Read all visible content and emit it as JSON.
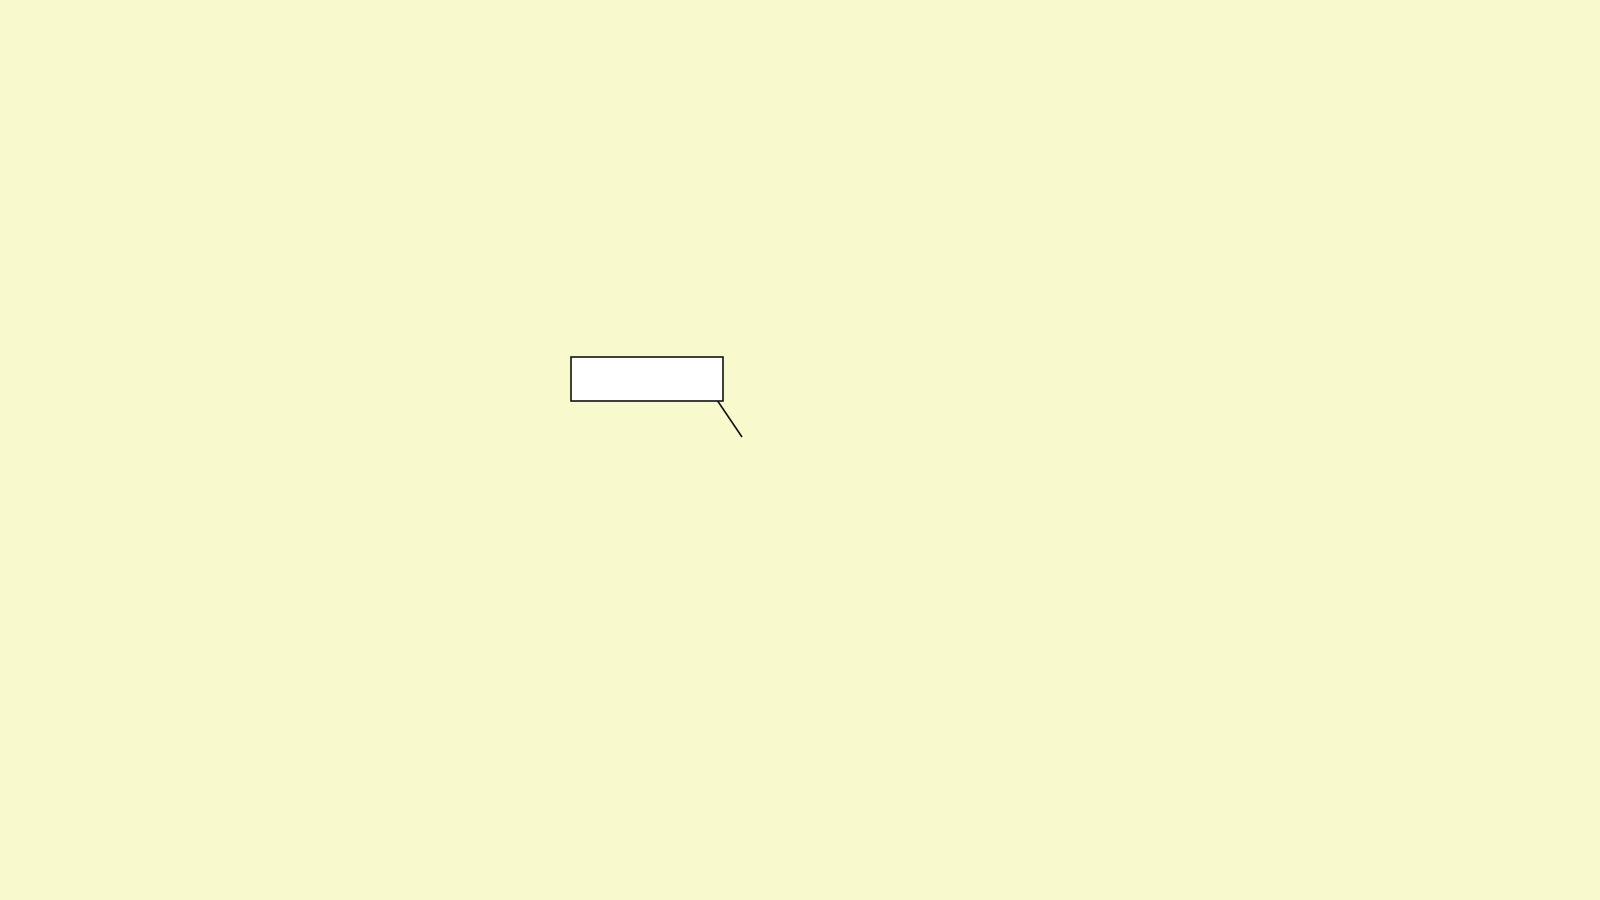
{
  "map": {
    "property_label": {
      "text": "The Property"
    },
    "compass": {
      "letter": "S"
    },
    "labels": [
      {
        "t": "CHURCH",
        "x": 215,
        "y": 62,
        "r": 38,
        "c": "street",
        "ls": 4
      },
      {
        "t": "STREET",
        "x": 318,
        "y": 24,
        "r": 70,
        "c": "street",
        "ls": 2
      },
      {
        "t": "LANE",
        "x": 506,
        "y": 36,
        "r": 50,
        "c": "street",
        "ls": 2
      },
      {
        "t": "PEPYS",
        "x": 443,
        "y": 82,
        "r": 45,
        "c": "street",
        "ls": 2
      },
      {
        "t": "CT",
        "x": 512,
        "y": 132,
        "r": 45,
        "c": "street",
        "ls": 1
      },
      {
        "t": "SCHOLARS",
        "x": 362,
        "y": 127,
        "r": -52,
        "c": "street",
        "ls": 1.5
      },
      {
        "t": "ALD",
        "x": 371,
        "y": 159,
        "r": -50,
        "c": "street",
        "ls": 1
      },
      {
        "t": "RANSOME",
        "x": 374,
        "y": 204,
        "r": 22,
        "c": "street",
        "ls": 1.5
      },
      {
        "t": "PL",
        "x": 431,
        "y": 197,
        "r": 22,
        "c": "street",
        "ls": 1
      },
      {
        "t": "ROAD",
        "x": 305,
        "y": 274,
        "r": 78,
        "c": "street",
        "ls": 1.5
      },
      {
        "t": "LONGWORTH AV",
        "x": 152,
        "y": 262,
        "r": -42,
        "c": "street",
        "ls": 1.5
      },
      {
        "t": "LONGWORTH AV",
        "x": 26,
        "y": 330,
        "r": -38,
        "c": "street",
        "ls": 1.5
      },
      {
        "t": "WHYTFORD CL",
        "x": 102,
        "y": 392,
        "r": -31,
        "c": "street",
        "ls": 1.5
      },
      {
        "t": "ST",
        "x": 163,
        "y": 456,
        "r": -55,
        "c": "street",
        "ls": 1
      },
      {
        "t": "ANDREW'S",
        "x": 218,
        "y": 390,
        "r": -57,
        "c": "street",
        "ls": 1.5
      },
      {
        "t": "LOGAN'S",
        "x": 198,
        "y": 444,
        "r": 70,
        "c": "street",
        "ls": 1.5
      },
      {
        "t": "WAY",
        "x": 277,
        "y": 566,
        "r": 75,
        "c": "street",
        "ls": 1
      },
      {
        "t": "WAY",
        "x": 153,
        "y": 573,
        "r": 62,
        "c": "street",
        "ls": 1
      },
      {
        "t": "MARINERS",
        "x": 57,
        "y": 636,
        "r": -18,
        "c": "street",
        "ls": 2
      },
      {
        "t": "CAPSTAN CL",
        "x": 96,
        "y": 700,
        "r": -13,
        "c": "street",
        "ls": 2
      },
      {
        "t": "PRIORY",
        "x": 206,
        "y": 849,
        "r": 76,
        "c": "street",
        "ls": 1
      },
      {
        "t": "RIVERSIDE",
        "x": 317,
        "y": 800,
        "r": -22,
        "c": "street",
        "ls": 1.5
      },
      {
        "t": "SAXON",
        "x": 321,
        "y": 821,
        "r": 78,
        "c": "street",
        "ls": 1
      },
      {
        "t": "RIVER",
        "x": 463,
        "y": 833,
        "r": 65,
        "c": "street",
        "ls": 1
      },
      {
        "t": "STEVENSON CT",
        "x": 556,
        "y": 836,
        "r": 40,
        "c": "street",
        "ls": 2
      },
      {
        "t": "CHEDDARS",
        "x": 762,
        "y": 682,
        "r": 33,
        "c": "street",
        "ls": 4
      },
      {
        "t": "LANE",
        "x": 813,
        "y": 724,
        "r": 58,
        "c": "street",
        "ls": 2
      },
      {
        "t": "NEWMARKET",
        "x": 1006,
        "y": 700,
        "r": -58,
        "c": "street",
        "ls": 3
      },
      {
        "t": "ROAD",
        "x": 1137,
        "y": 573,
        "r": -38,
        "c": "street",
        "ls": 2
      },
      {
        "t": "A1134",
        "x": 1191,
        "y": 489,
        "r": -44,
        "c": "street",
        "s": 13,
        "ls": 1
      },
      {
        "t": "STANLEY",
        "x": 824,
        "y": 398,
        "r": 37,
        "c": "street",
        "ls": 3
      },
      {
        "t": "ROAD",
        "x": 918,
        "y": 477,
        "r": 37,
        "c": "street",
        "ls": 2
      },
      {
        "t": "OYSTER",
        "x": 862,
        "y": 361,
        "r": -45,
        "c": "street",
        "ls": 3
      },
      {
        "t": "ROW",
        "x": 911,
        "y": 312,
        "r": -45,
        "c": "street",
        "ls": 2
      },
      {
        "t": "GARLIC",
        "x": 1018,
        "y": 346,
        "r": 47,
        "c": "street",
        "ls": 2
      },
      {
        "t": "ROW",
        "x": 1069,
        "y": 413,
        "r": 47,
        "c": "street",
        "ls": 1
      },
      {
        "t": "MERCERS",
        "x": 1110,
        "y": 260,
        "r": -37,
        "c": "street",
        "ls": 2
      },
      {
        "t": "SWANNS",
        "x": 1197,
        "y": 194,
        "r": -40,
        "c": "street",
        "ls": 1.5
      },
      {
        "t": "ROW",
        "x": 1233,
        "y": 163,
        "r": -40,
        "c": "street",
        "ls": 1
      },
      {
        "t": "ROAD",
        "x": 1293,
        "y": 302,
        "r": 45,
        "c": "street",
        "ls": 2
      },
      {
        "t": "SWANNS RD",
        "x": 1320,
        "y": 345,
        "r": 85,
        "c": "street",
        "s": 10.5,
        "ls": 1
      },
      {
        "t": "RIVERSIDE",
        "x": 645,
        "y": 322,
        "r": -62,
        "c": "street",
        "ls": 2
      },
      {
        "t": "ST",
        "x": 560,
        "y": 425,
        "r": 26,
        "c": "street",
        "ls": 1
      },
      {
        "t": "BARTHOLOMEW",
        "x": 543,
        "y": 441,
        "r": 26,
        "c": "street",
        "ls": 3
      },
      {
        "t": "CT",
        "x": 628,
        "y": 481,
        "r": 26,
        "c": "street",
        "ls": 2
      },
      {
        "t": "Recreation",
        "x": 44,
        "y": 131,
        "r": 0,
        "c": "area"
      },
      {
        "t": "Ground",
        "x": 45,
        "y": 155,
        "r": 0,
        "c": "area"
      },
      {
        "t": "Pav",
        "x": 133,
        "y": 57,
        "r": 0,
        "c": "area",
        "s": 10
      },
      {
        "t": "PW",
        "x": 264,
        "y": 176,
        "r": 0,
        "c": "area",
        "s": 10.5
      },
      {
        "t": "Wks",
        "x": 318,
        "y": 362,
        "r": 0,
        "c": "area"
      },
      {
        "t": "Play",
        "x": 792,
        "y": 225,
        "r": 0,
        "c": "area",
        "s": 10
      },
      {
        "t": "Area",
        "x": 791,
        "y": 241,
        "r": 0,
        "c": "area",
        "s": 10
      },
      {
        "t": "REGATTA",
        "x": 826,
        "y": 240,
        "r": 46,
        "c": "area",
        "ls": 5
      },
      {
        "t": "Depots",
        "x": 780,
        "y": 479,
        "r": 0,
        "c": "area",
        "s": 10
      },
      {
        "t": "Depots",
        "x": 1089,
        "y": 529,
        "r": 0,
        "c": "area",
        "s": 10
      },
      {
        "t": "Mus",
        "x": 645,
        "y": 556,
        "r": 0,
        "c": "area",
        "s": 10
      },
      {
        "t": "PW",
        "x": 806,
        "y": 650,
        "r": 0,
        "c": "area",
        "s": 10.5
      },
      {
        "t": "PW",
        "x": 936,
        "y": 562,
        "r": 0,
        "c": "area",
        "s": 10.5
      },
      {
        "t": "PW",
        "x": 1495,
        "y": 332,
        "r": 0,
        "c": "area",
        "s": 10.5
      },
      {
        "t": "Superstore",
        "x": 737,
        "y": 769,
        "r": 0,
        "c": "area",
        "s": 15
      },
      {
        "t": "War",
        "x": 703,
        "y": 853,
        "r": 0,
        "c": "area",
        "s": 10.5
      },
      {
        "t": "Meml",
        "x": 706,
        "y": 877,
        "r": 0,
        "c": "area",
        "s": 10.5
      },
      {
        "t": "Boat House",
        "x": 327,
        "y": 701,
        "r": -7,
        "c": "area",
        "s": 10.5
      },
      {
        "t": "Underpasses",
        "x": 95,
        "y": 779,
        "r": 0,
        "c": "area",
        "s": 10.5
      },
      {
        "t": "Kennels",
        "x": 1567,
        "y": 180,
        "r": 0,
        "c": "area",
        "s": 11.5
      },
      {
        "t": "Barnwell",
        "x": 1555,
        "y": 214,
        "r": 0,
        "c": "area"
      },
      {
        "t": "Junction",
        "x": 1557,
        "y": 236,
        "r": 0,
        "c": "area"
      },
      {
        "t": "Path",
        "x": 818,
        "y": 44,
        "r": 78,
        "c": "area",
        "s": 10
      },
      {
        "t": "Path",
        "x": 1351,
        "y": 875,
        "r": 70,
        "c": "area",
        "s": 10
      },
      {
        "t": "Abbey",
        "x": 1612,
        "y": 593,
        "r": 0,
        "c": "area",
        "s": 10
      },
      {
        "t": "Stadium",
        "x": 1618,
        "y": 613,
        "r": 0,
        "c": "area",
        "s": 10
      },
      {
        "t": "6m",
        "x": 253,
        "y": 787,
        "r": 0,
        "c": "h",
        "s": 10
      },
      {
        "t": "6m",
        "x": 237,
        "y": 255,
        "r": 0,
        "c": "h",
        "s": 10
      },
      {
        "t": "8m",
        "x": 1591,
        "y": 306,
        "r": 0,
        "c": "h",
        "s": 10
      },
      {
        "t": "8m",
        "x": 1492,
        "y": 362,
        "r": 0,
        "c": "h",
        "s": 10
      },
      {
        "t": "10m",
        "x": 1262,
        "y": 368,
        "r": 0,
        "c": "o",
        "s": 10
      },
      {
        "t": "10m",
        "x": 1186,
        "y": 651,
        "r": -78,
        "c": "o",
        "s": 10
      },
      {
        "t": "River Cam",
        "x": 512,
        "y": 518,
        "r": -73,
        "c": "water",
        "s": 24,
        "ls": 1
      },
      {
        "t": "Drain",
        "x": 546,
        "y": 237,
        "r": 78,
        "c": "water",
        "s": 9
      },
      {
        "t": "Coldhams Brook",
        "x": 1612,
        "y": 899,
        "r": 10,
        "c": "water",
        "s": 13
      }
    ]
  }
}
